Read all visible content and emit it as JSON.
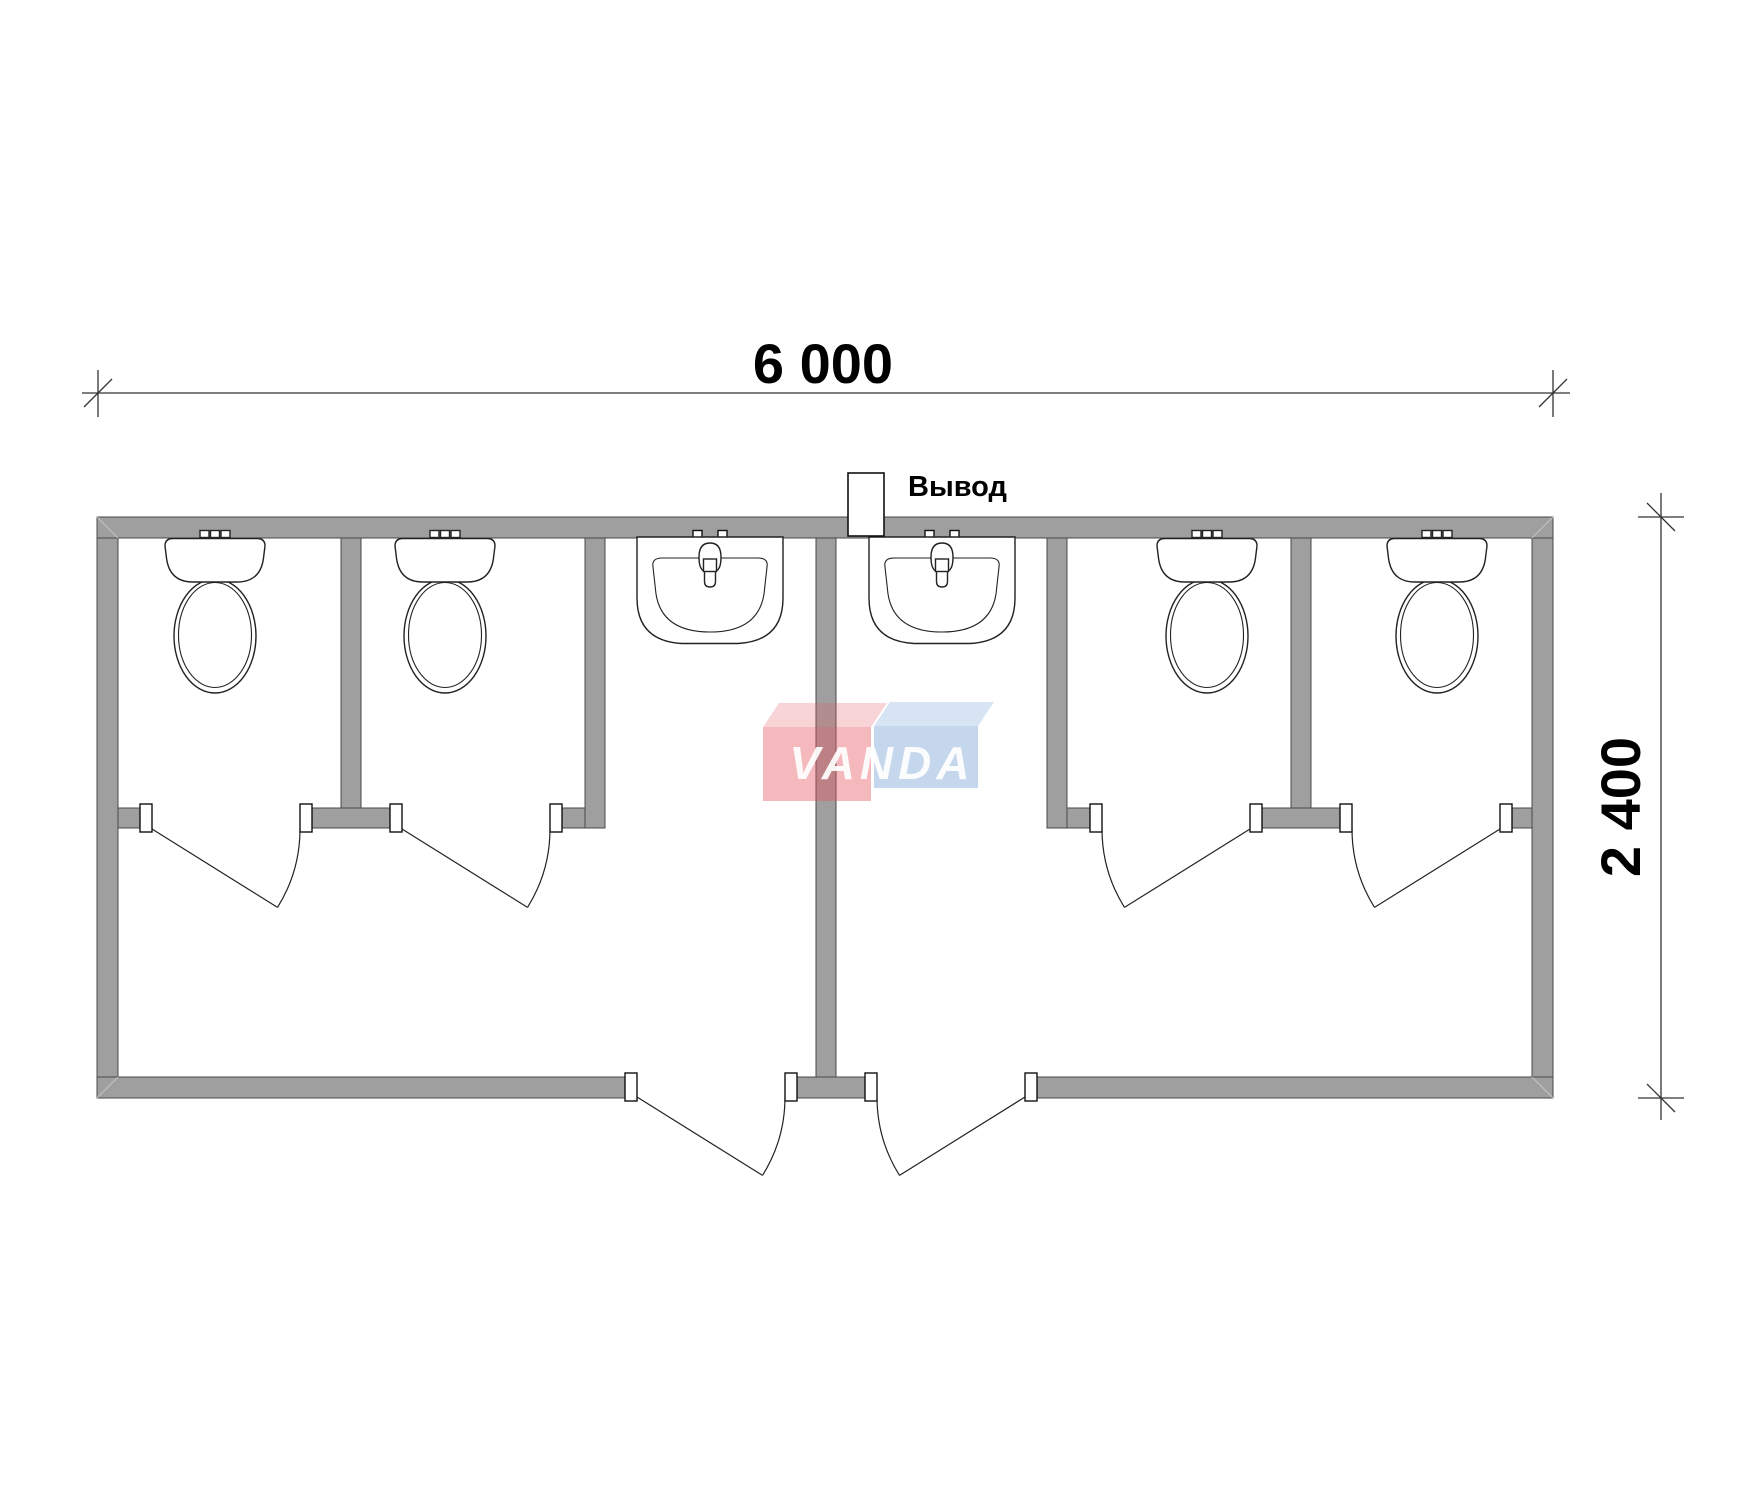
{
  "drawing": {
    "type": "floor-plan",
    "subject": "sanitary container module with toilets and washbasins",
    "dimensions": {
      "width_label": "6 000",
      "height_label": "2 400"
    },
    "outlet": {
      "label": "Вывод"
    },
    "watermark": {
      "text": "VANDA"
    },
    "inventory": {
      "toilet_stalls": 4,
      "washbasins": 2,
      "entrance_doors": 2,
      "stall_doors": 4
    },
    "colors": {
      "wall": "#9f9f9f",
      "wall-edge": "#4a4a4a",
      "outline": "#222222",
      "dim": "#333333",
      "miter": "#c2c2c2"
    }
  }
}
